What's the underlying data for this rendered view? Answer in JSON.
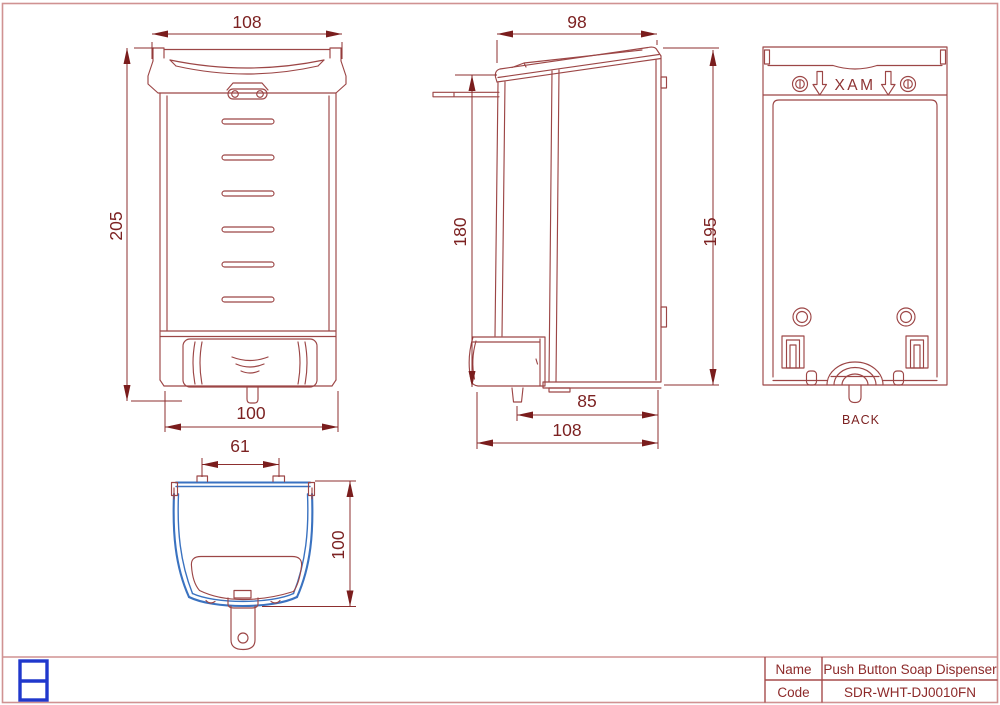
{
  "views": {
    "front": {
      "dim_width_top": "108",
      "dim_height": "205",
      "dim_width_bottom": "100"
    },
    "side": {
      "dim_depth_top": "98",
      "dim_height_front": "180",
      "dim_height_back": "195",
      "dim_nozzle_offset": "85",
      "dim_depth_total": "108"
    },
    "back": {
      "mirrored_max_label": "XAM",
      "caption": "BACK"
    },
    "bottom": {
      "dim_tab_spacing": "61",
      "dim_depth": "100"
    }
  },
  "title_block": {
    "name_label": "Name",
    "name_value": "Push Button Soap Dispenser",
    "code_label": "Code",
    "code_value": "SDR-WHT-DJ0010FN"
  },
  "colors": {
    "drawing_red": "#9c4646",
    "dimension_red": "#7a1d1d",
    "accent_blue": "#3a72c0",
    "logo_blue": "#2038cc",
    "frame_pink": "#d09292"
  }
}
